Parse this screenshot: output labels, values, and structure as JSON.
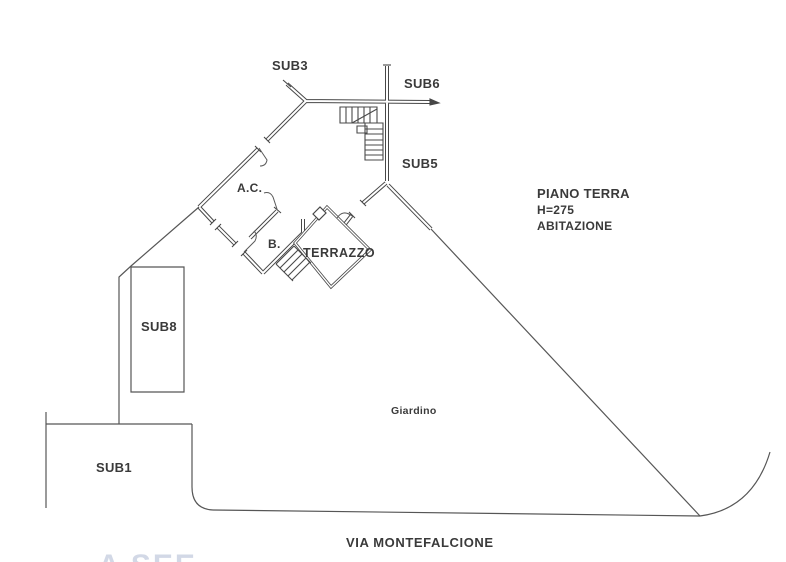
{
  "plan": {
    "title_block": {
      "line1": "PIANO TERRA",
      "line2": "H=275",
      "line3": "ABITAZIONE"
    },
    "units": {
      "sub3": "SUB3",
      "sub6": "SUB6",
      "sub5": "SUB5",
      "sub8": "SUB8",
      "sub1": "SUB1"
    },
    "rooms": {
      "ac": "A.C.",
      "bath": "B.",
      "terrace": "TERRAZZO",
      "garden": "Giardino"
    },
    "street": "VIA MONTEFALCIONE",
    "watermark": "A SEE",
    "colors": {
      "ink": "#474747",
      "text": "#3a3a3a",
      "paper": "#ffffff",
      "watermark": "#aebad2"
    }
  }
}
